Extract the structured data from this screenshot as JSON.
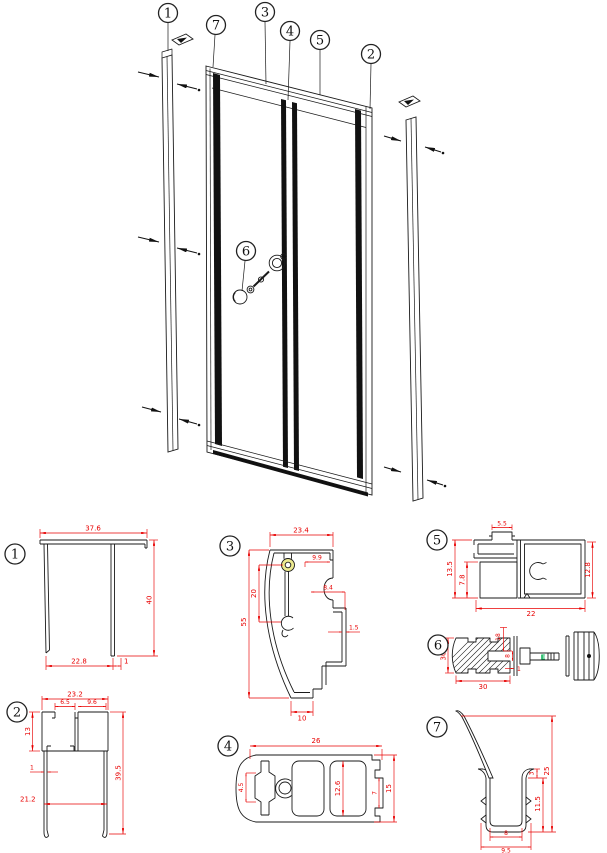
{
  "colors": {
    "line": "#1a1a1a",
    "dimension": "#e80000",
    "boss_fill": "#ece98f",
    "clip_mark": "#00b050"
  },
  "callouts": {
    "c1": "1",
    "c2": "2",
    "c3": "3",
    "c4": "4",
    "c5": "5",
    "c6": "6",
    "c7": "7"
  },
  "profiles": {
    "p1": {
      "num": "1",
      "dim_width": "37.6",
      "dim_height": "40",
      "dim_bottom": "22.8",
      "dim_lip": "1"
    },
    "p2": {
      "num": "2",
      "dim_width": "23.2",
      "dim_opening": "6.5",
      "dim_channel": "9.6",
      "dim_depth": "13",
      "dim_height": "39.5",
      "dim_wall": "1",
      "dim_span": "21.2"
    },
    "p3": {
      "num": "3",
      "dim_width": "23.4",
      "dim_top_offset": "9.9",
      "dim_centers": "20",
      "dim_pocket": "8.4",
      "dim_wall": "1.5",
      "dim_height": "55",
      "dim_foot": "10"
    },
    "p4": {
      "num": "4",
      "dim_width": "26",
      "dim_slot": "4.5",
      "dim_inner": "12.6",
      "dim_tab": "7",
      "dim_height": "15"
    },
    "p5": {
      "num": "5",
      "dim_hat": "5.5",
      "dim_left": "13.5",
      "dim_inner": "7.8",
      "dim_right": "12.8",
      "dim_width": "22"
    },
    "p6": {
      "num": "6",
      "dim_screw": "18",
      "dim_height": "30",
      "dim_width": "30",
      "dim_slot": "8",
      "dim_washer": "1",
      "clip_mark": "E"
    },
    "p7": {
      "num": "7",
      "dim_total": "25",
      "dim_channel": "11.5",
      "dim_lip": "3",
      "dim_inner": "8",
      "dim_outer": "9.5"
    }
  }
}
